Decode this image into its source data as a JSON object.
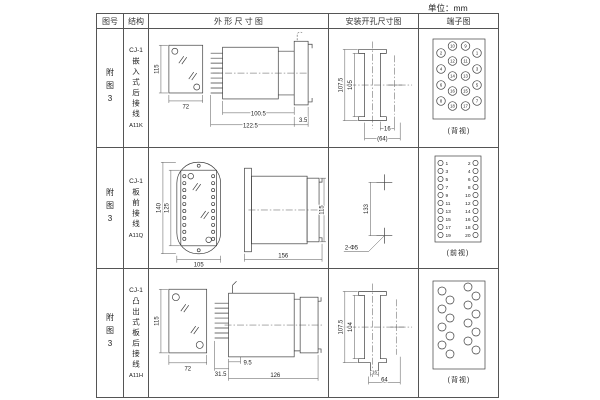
{
  "page": {
    "unit_label": "单位：mm"
  },
  "header": {
    "fig_no": "图号",
    "structure": "结构",
    "outline": "外 形 尺 寸 图",
    "mounting": "安装开孔尺寸图",
    "terminal": "端子图"
  },
  "rows": [
    {
      "fig_no": "附图3",
      "model": "CJ-1",
      "structure": "嵌入式后接线",
      "code": "A11K",
      "outline": {
        "front_h": "115",
        "front_w": "72",
        "body_len": "100.5",
        "total_len": "122.5",
        "flange_t": "3.5"
      },
      "mounting": {
        "outer_h": "107.5",
        "inner_h": "105",
        "hole_w": "16",
        "span_w": "(64)"
      },
      "terminal": {
        "view": "(背视)",
        "col_a": [
          "2",
          "4",
          "6",
          "8"
        ],
        "col_b": [
          "10",
          "12",
          "14",
          "16",
          "18"
        ],
        "col_c": [
          "9",
          "11",
          "13",
          "15",
          "17"
        ],
        "col_d": [
          "1",
          "3",
          "5",
          "7"
        ]
      }
    },
    {
      "fig_no": "附图3",
      "model": "CJ-1",
      "structure": "板前接线",
      "code": "A11Q",
      "outline": {
        "front_h_outer": "140",
        "front_h_inner": "125",
        "front_w": "105",
        "side_len": "156",
        "side_h": "115"
      },
      "mounting": {
        "hole_pitch": "133",
        "hole_note": "2-Φ5"
      },
      "terminal": {
        "view": "(前视)",
        "left": [
          "1",
          "3",
          "5",
          "7",
          "9",
          "11",
          "13",
          "15",
          "17",
          "19"
        ],
        "right": [
          "2",
          "4",
          "6",
          "8",
          "10",
          "12",
          "14",
          "16",
          "18",
          "20"
        ]
      }
    },
    {
      "fig_no": "附图3",
      "model": "CJ-1",
      "structure": "凸出式板后接线",
      "code": "A11H",
      "outline": {
        "front_h": "115",
        "front_w": "72",
        "pin_len": "31.5",
        "stub_len": "9.5",
        "body_len": "126"
      },
      "mounting": {
        "outer_h": "107.5",
        "inner_h": "104",
        "notch_w": "16",
        "span_w": "64"
      },
      "terminal": {
        "view": "(背视)"
      }
    }
  ]
}
